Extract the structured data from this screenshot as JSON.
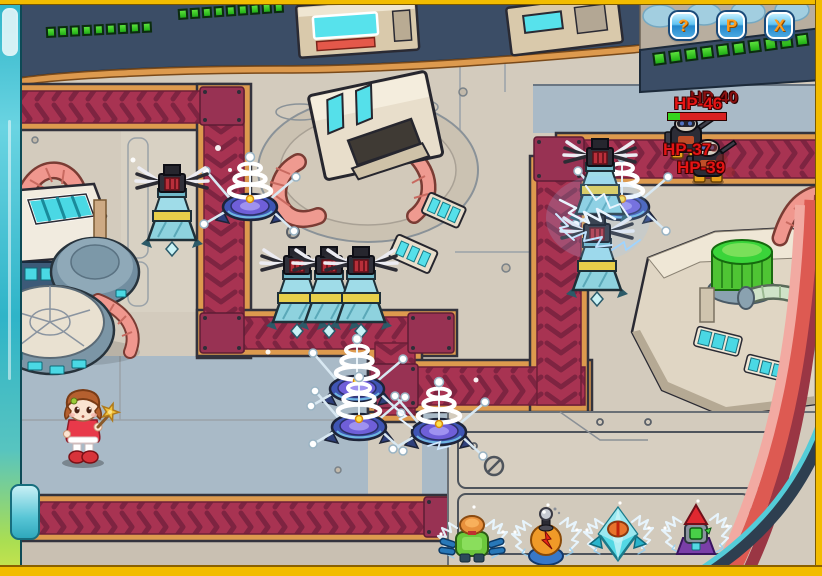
{
  "hud": {
    "buttons": [
      {
        "id": "help",
        "label": "?"
      },
      {
        "id": "pause",
        "label": "P"
      },
      {
        "id": "close",
        "label": "X"
      }
    ],
    "wave_bars": [
      {
        "position": "top-left",
        "segments": 9
      },
      {
        "position": "top-center",
        "segments": 9
      },
      {
        "position": "top-right",
        "segments": 10
      }
    ]
  },
  "enemies": {
    "labels": [
      {
        "id": "enemy-hp-40",
        "text": "HP-40"
      },
      {
        "id": "enemy-hp-46",
        "text": "HP-46"
      },
      {
        "id": "enemy-hp-37",
        "text": "HP-37"
      },
      {
        "id": "enemy-hp-39",
        "text": "HP-39"
      }
    ],
    "health_bar": {
      "percent_remaining": 20
    }
  },
  "towers": {
    "tesla_count": 5,
    "gatling_count": 6
  },
  "shop": {
    "items": [
      {
        "id": "mech-cannon-tower"
      },
      {
        "id": "lightning-potion-tower"
      },
      {
        "id": "crystal-tower"
      },
      {
        "id": "rocket-tower"
      }
    ]
  },
  "colors": {
    "path": "#a83352",
    "path_border": "#dd9a4e",
    "frame_yellow": "#f2bc00",
    "hp_text": "#e41414",
    "segment_green": "#35d426",
    "button_blue": "#4aa8e0",
    "button_glyph": "#ff9c1c",
    "sidebar_teal": "#3fc2d4"
  }
}
